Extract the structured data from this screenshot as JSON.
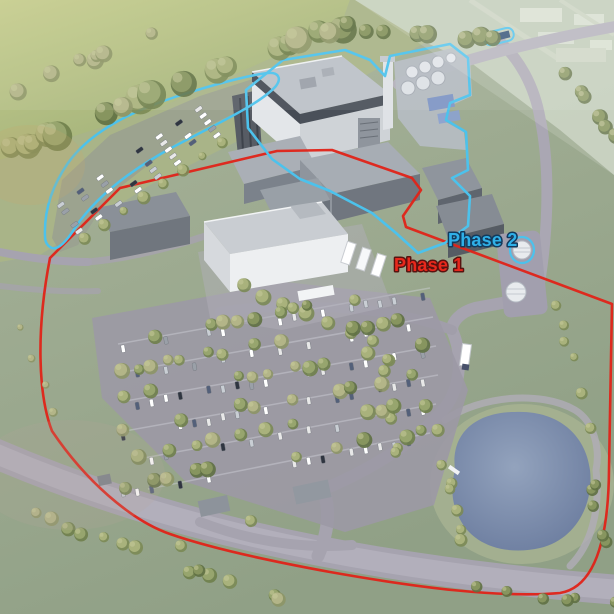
{
  "scene": {
    "type": "3d-aerial-site-render",
    "description": "Aerial architectural rendering of an industrial campus showing phased development boundaries",
    "labels": {
      "phase1": "Phase 1",
      "phase2": "Phase 2"
    },
    "colors": {
      "phase1_outline": "#e02318",
      "phase2_outline": "#4cc2ec",
      "phase1_text": "#e8281c",
      "phase2_text": "#2fb0e8",
      "field": "#b4c188",
      "site_grass": "#9fab8d",
      "road": "#a6a3af",
      "pond": "#7586a6",
      "building_light": "#e3e6e9",
      "building_dark": "#575c64",
      "tree": "#7b8a55"
    },
    "features": [
      "production-hall",
      "utility-tank-yard",
      "process-halls",
      "office-building",
      "loading-dock-trucks",
      "storage-tanks",
      "overflow-parking",
      "staff-parking",
      "retention-pond",
      "perimeter-road",
      "gatehouse",
      "tree-hedgerow"
    ]
  }
}
